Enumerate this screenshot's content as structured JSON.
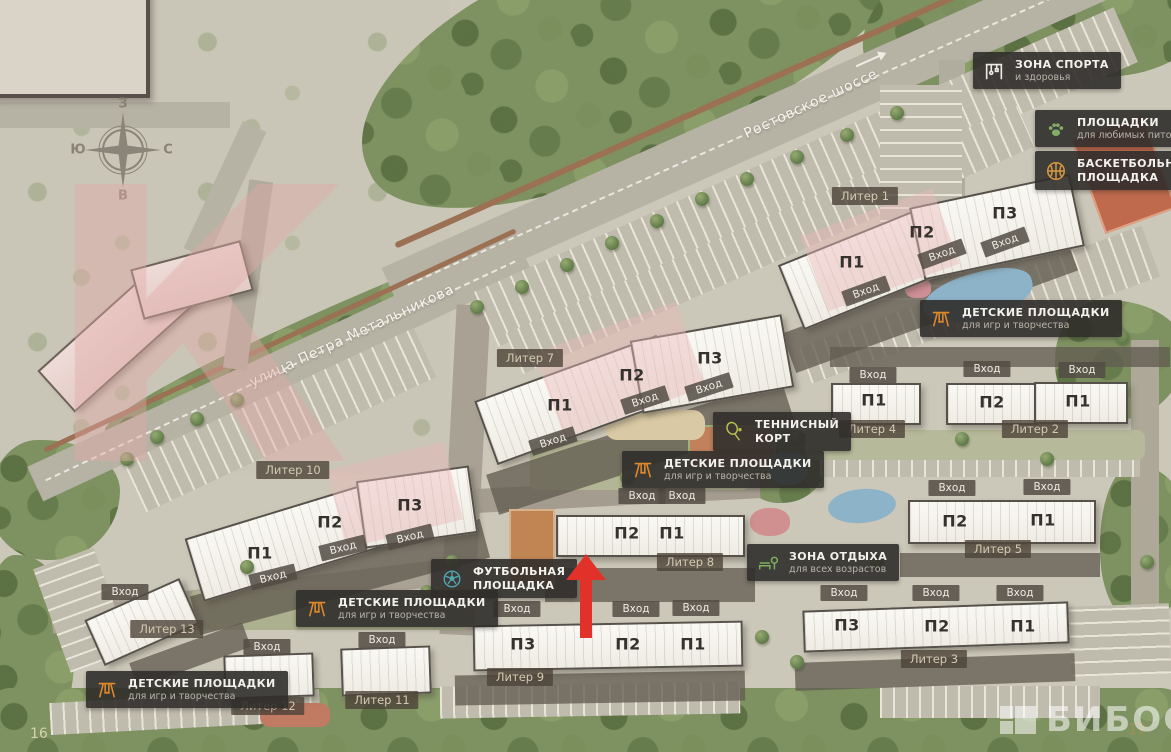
{
  "page": {
    "left_page_number": "16",
    "right_page_number": "17",
    "watermark_logo": "БИБОСС",
    "watermark_letter": "К"
  },
  "compass": {
    "top": "З",
    "right": "С",
    "bottom": "В",
    "left": "Ю"
  },
  "streets": [
    {
      "name": "Ростовское шоссе"
    },
    {
      "name": "улица Петра Метальникова"
    }
  ],
  "labels": {
    "entrance": "Вход"
  },
  "buildings": [
    {
      "id": "liter-1",
      "label": "Литер 1",
      "sections": [
        "П1",
        "П2",
        "П3"
      ]
    },
    {
      "id": "liter-2",
      "label": "Литер 2",
      "sections": [
        "П2",
        "П1"
      ]
    },
    {
      "id": "liter-3",
      "label": "Литер 3",
      "sections": [
        "П3",
        "П2",
        "П1"
      ]
    },
    {
      "id": "liter-4",
      "label": "Литер 4",
      "sections": [
        "П1"
      ]
    },
    {
      "id": "liter-5",
      "label": "Литер 5",
      "sections": [
        "П2",
        "П1"
      ]
    },
    {
      "id": "liter-7",
      "label": "Литер 7",
      "sections": [
        "П1",
        "П2",
        "П3"
      ]
    },
    {
      "id": "liter-8",
      "label": "Литер 8",
      "sections": [
        "П2",
        "П1"
      ]
    },
    {
      "id": "liter-9",
      "label": "Литер 9",
      "sections": [
        "П3",
        "П2",
        "П1"
      ]
    },
    {
      "id": "liter-10",
      "label": "Литер 10",
      "sections": [
        "П1",
        "П2",
        "П3"
      ]
    },
    {
      "id": "liter-11",
      "label": "Литер 11",
      "sections": []
    },
    {
      "id": "liter-12",
      "label": "Литер 12",
      "sections": []
    },
    {
      "id": "liter-13",
      "label": "Литер 13",
      "sections": []
    }
  ],
  "amenities": [
    {
      "id": "sport-zone",
      "icon": "gym-icon",
      "title": "ЗОНА СПОРТА",
      "subtitle": "и здоровья"
    },
    {
      "id": "pet-playgrounds",
      "icon": "pets-icon",
      "title": "ПЛОЩАДКИ",
      "subtitle": "для любимых питомцев"
    },
    {
      "id": "basketball",
      "icon": "basketball-icon",
      "title": "БАСКЕТБОЛЬНАЯ",
      "subtitle": "ПЛОЩАДКА"
    },
    {
      "id": "kids-northeast",
      "icon": "playground-icon",
      "title": "ДЕТСКИЕ ПЛОЩАДКИ",
      "subtitle": "для игр и творчества"
    },
    {
      "id": "tennis-court",
      "icon": "tennis-icon",
      "title": "ТЕННИСНЫЙ",
      "subtitle": "КОРТ"
    },
    {
      "id": "kids-center",
      "icon": "playground-icon",
      "title": "ДЕТСКИЕ ПЛОЩАДКИ",
      "subtitle": "для игр и творчества"
    },
    {
      "id": "rest-zone",
      "icon": "bench-icon",
      "title": "ЗОНА ОТДЫХА",
      "subtitle": "для всех возрастов"
    },
    {
      "id": "football",
      "icon": "football-icon",
      "title": "ФУТБОЛЬНАЯ",
      "subtitle": "ПЛОЩАДКА"
    },
    {
      "id": "kids-midleft",
      "icon": "playground-icon",
      "title": "ДЕТСКИЕ ПЛОЩАДКИ",
      "subtitle": "для игр и творчества"
    },
    {
      "id": "kids-southwest",
      "icon": "playground-icon",
      "title": "ДЕТСКИЕ ПЛОЩАДКИ",
      "subtitle": "для игр и творчества"
    }
  ],
  "colors": {
    "arrow_red": "#e23128",
    "badge_bg": "#302e2b",
    "building_fill": "#f8f6f1",
    "pink_watermark": "#e3aaa7",
    "vegetation": "#7e9161",
    "road": "#b6b2a4"
  }
}
